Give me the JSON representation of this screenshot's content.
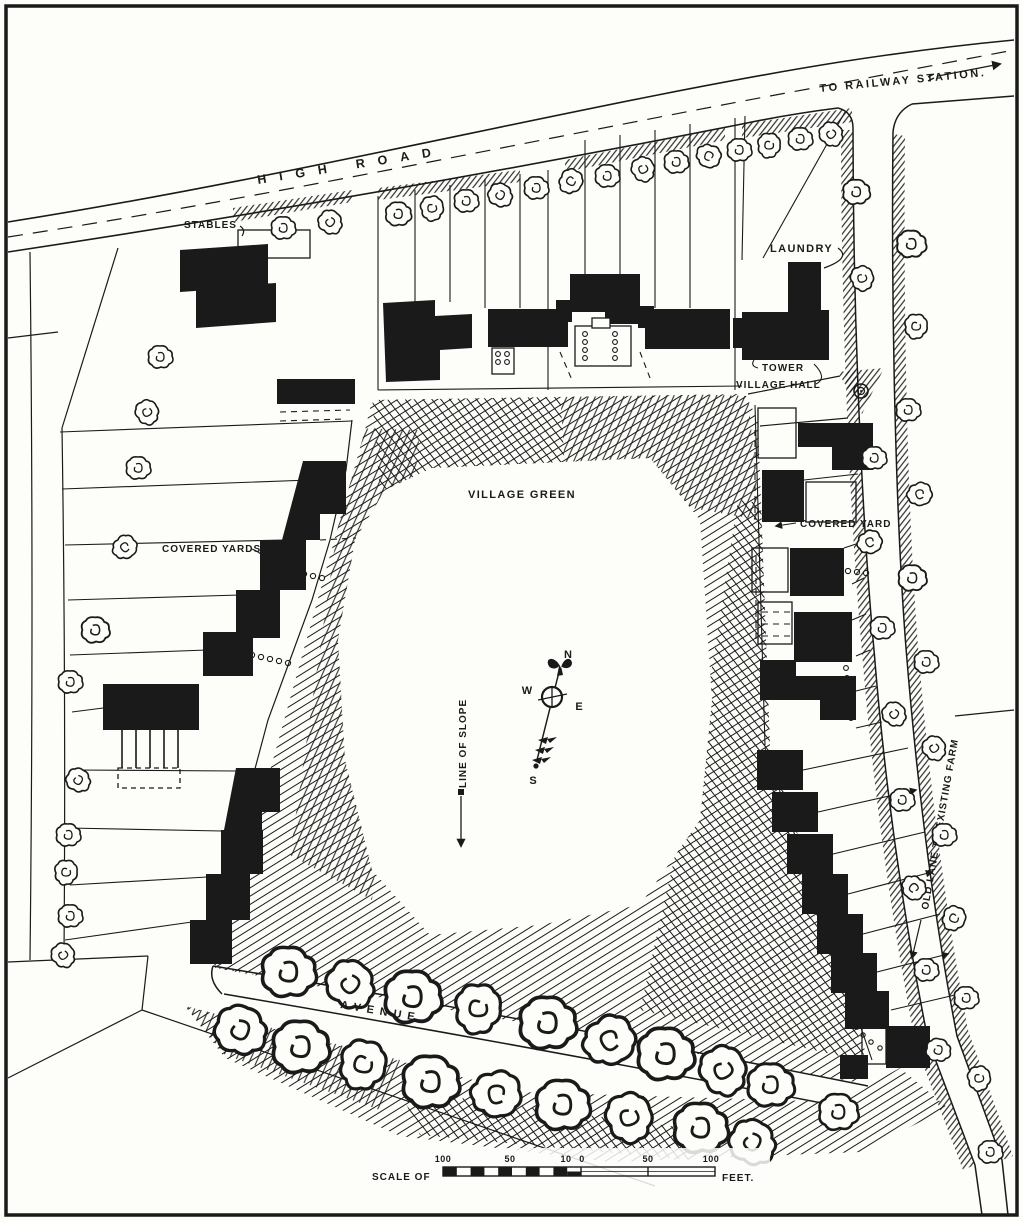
{
  "title": "Village plan with central green",
  "labels": {
    "high_road": "HIGH ROAD",
    "to_railway_station": "TO RAILWAY STATION.",
    "stables": "STABLES",
    "laundry": "LAUNDRY",
    "tower": "TOWER",
    "village_hall": "VILLAGE HALL",
    "village_green": "VILLAGE GREEN",
    "covered_yards": "COVERED YARDS",
    "covered_yard": "COVERED YARD",
    "line_of_slope": "LINE OF SLOPE",
    "old_lane": "OLD LANE TO EXISTING FARM",
    "avenue": "AVENUE.",
    "scale_prefix": "SCALE OF",
    "scale_suffix": "FEET."
  },
  "compass": {
    "n": "N",
    "e": "E",
    "s": "S",
    "w": "W"
  },
  "scale": {
    "ticks": [
      "100",
      "50",
      "10",
      "0",
      "50",
      "100"
    ]
  },
  "colors": {
    "ink": "#1a1a1a",
    "paper": "#fdfdfa"
  }
}
